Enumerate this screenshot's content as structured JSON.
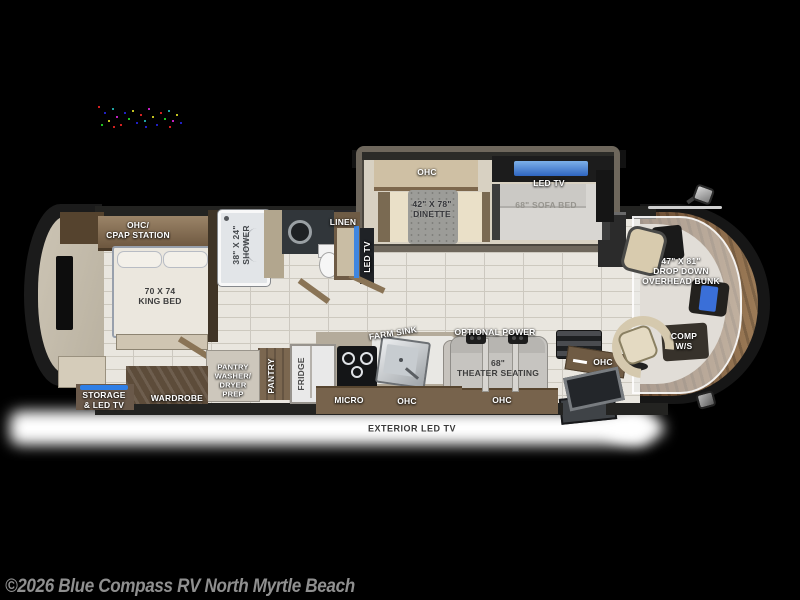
{
  "floorplan": {
    "labels": {
      "ohc_cpap": "OHC/\nCPAP STATION",
      "king_bed": "70 X 74\nKING BED",
      "shower": "38\" X 24\"\nSHOWER",
      "linen": "LINEN",
      "led_tv_wall": "LED TV",
      "slide_ohc": "OHC",
      "dinette": "42\" X 78\"\nDINETTE",
      "slide_led_tv": "LED TV",
      "sofa_bed": "68\" SOFA BED",
      "overhead_bunk": "47\" X 81\"\nDROP DOWN\nOVERHEAD BUNK",
      "comp_ws": "COMP\nW/S",
      "optional_power": "OPTIONAL POWER",
      "theater_seating": "68\"\nTHEATER SEATING",
      "door_ohc": "OHC",
      "kitchen_ohc": "OHC",
      "theater_ohc": "OHC",
      "micro": "MICRO",
      "farm_sink": "FARM SINK",
      "fridge": "FRIDGE",
      "pantry": "PANTRY",
      "pantry_washer_dryer": "PANTRY\nWASHER/\nDRYER\nPREP",
      "wardrobe": "WARDROBE",
      "storage_led_tv": "STORAGE\n& LED TV",
      "exterior_led_tv": "EXTERIOR LED TV"
    },
    "colors": {
      "background": "#000000",
      "hull": "#1b1b1b",
      "tile_floor": "#e9e6df",
      "wood_band": "#77634c",
      "wood_dark": "#5d4c3a",
      "cabinet_beige": "#cfc0a4",
      "dash_wood": "#8a6a49",
      "led_accent_blue": "#3a78d6",
      "label_white": "#ffffff",
      "label_dark": "#3e3e3e",
      "under_glow": "#ffffff",
      "copyright_gray": "#8f8f8f"
    }
  },
  "footer": {
    "copyright": "©2026 Blue Compass RV North Myrtle Beach"
  }
}
